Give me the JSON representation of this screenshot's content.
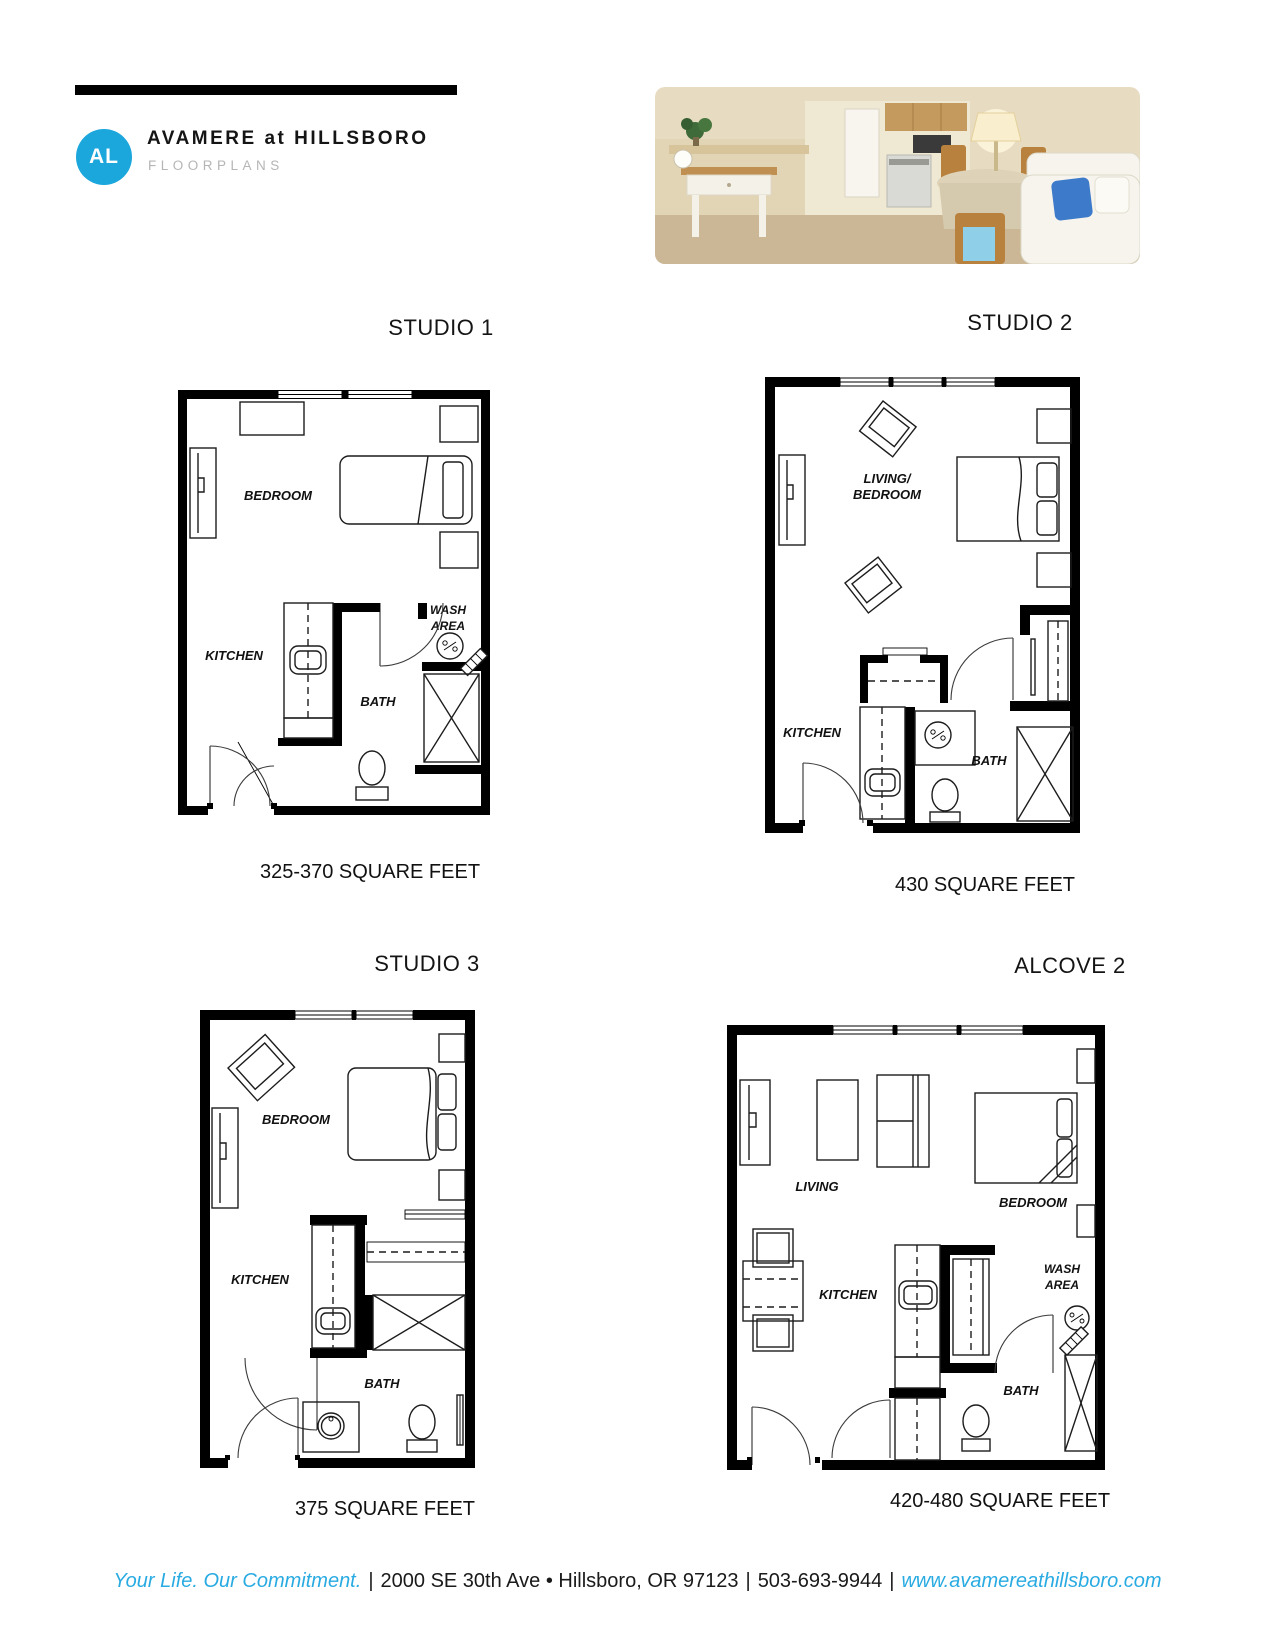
{
  "header": {
    "logo_text": "AL",
    "logo_color": "#1ba6dc",
    "brand": "AVAMERE at HILLSBORO",
    "subtitle": "FLOORPLANS"
  },
  "floorplans": [
    {
      "title": "STUDIO 1",
      "sqft": "325-370 SQUARE FEET",
      "labels": {
        "bedroom": "BEDROOM",
        "kitchen": "KITCHEN",
        "wash1": "WASH",
        "wash2": "AREA",
        "bath": "BATH"
      }
    },
    {
      "title": "STUDIO 2",
      "sqft": "430 SQUARE FEET",
      "labels": {
        "living1": "LIVING/",
        "living2": "BEDROOM",
        "kitchen": "KITCHEN",
        "bath": "BATH"
      }
    },
    {
      "title": "STUDIO 3",
      "sqft": "375 SQUARE FEET",
      "labels": {
        "bedroom": "BEDROOM",
        "kitchen": "KITCHEN",
        "bath": "BATH"
      }
    },
    {
      "title": "ALCOVE 2",
      "sqft": "420-480 SQUARE FEET",
      "labels": {
        "living": "LIVING",
        "bedroom": "BEDROOM",
        "kitchen": "KITCHEN",
        "wash1": "WASH",
        "wash2": "AREA",
        "bath": "BATH"
      }
    }
  ],
  "footer": {
    "tagline": "Your Life. Our Commitment.",
    "sep": "|",
    "address": "2000 SE 30th Ave • Hillsboro, OR 97123",
    "phone": "503-693-9944",
    "website": "www.avamereathillsboro.com",
    "accent_color": "#29abe2"
  }
}
